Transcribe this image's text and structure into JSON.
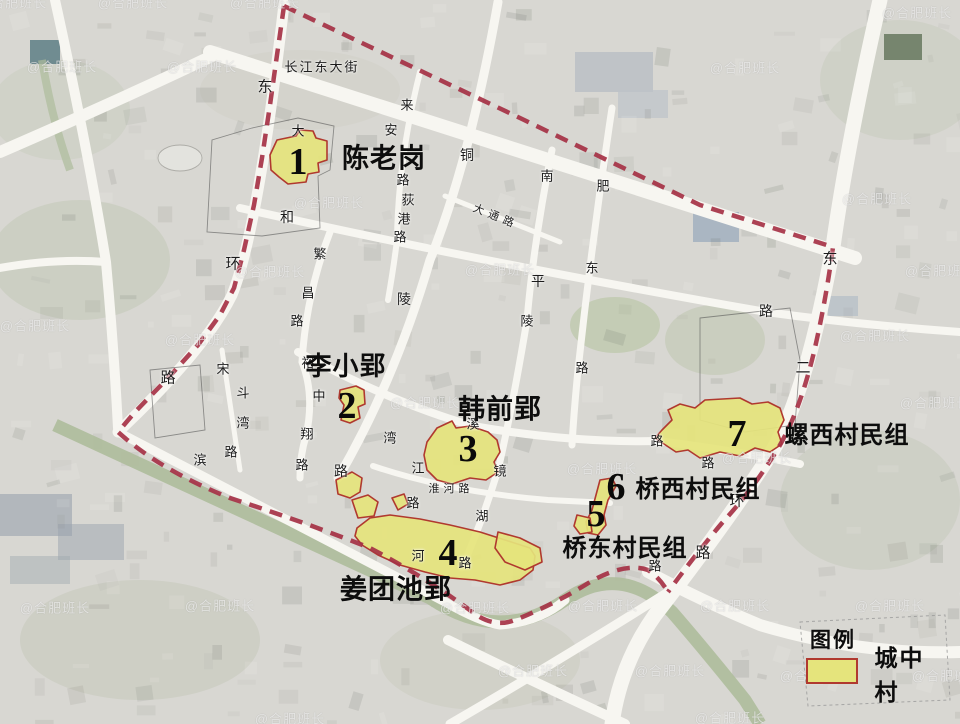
{
  "sites": [
    {
      "num": "1",
      "name": "陈老岗",
      "num_x": 298,
      "num_y": 162,
      "label_x": 384,
      "label_y": 159,
      "label_size": 27
    },
    {
      "num": "2",
      "name": "李小郢",
      "num_x": 347,
      "num_y": 406,
      "label_x": 346,
      "label_y": 366,
      "label_size": 26
    },
    {
      "num": "3",
      "name": "韩前郢",
      "num_x": 468,
      "num_y": 449,
      "label_x": 500,
      "label_y": 410,
      "label_size": 27
    },
    {
      "num": "4",
      "name": "姜团池郢",
      "num_x": 448,
      "num_y": 553,
      "label_x": 396,
      "label_y": 590,
      "label_size": 27
    },
    {
      "num": "5",
      "name": "桥东村民组",
      "num_x": 596,
      "num_y": 514,
      "label_x": 625,
      "label_y": 549,
      "label_size": 24
    },
    {
      "num": "6",
      "name": "桥西村民组",
      "num_x": 616,
      "num_y": 487,
      "label_x": 698,
      "label_y": 490,
      "label_size": 24
    },
    {
      "num": "7",
      "name": "螺西村民组",
      "num_x": 737,
      "num_y": 434,
      "label_x": 847,
      "label_y": 436,
      "label_size": 24
    }
  ],
  "legend": {
    "title": "图例",
    "item_label": "城中村"
  },
  "road_labels": [
    {
      "t": "长江东大街",
      "x": 322,
      "y": 66,
      "s": 13,
      "ls": 2
    },
    {
      "t": "东",
      "x": 265,
      "y": 86,
      "s": 15
    },
    {
      "t": "环",
      "x": 233,
      "y": 263,
      "s": 15
    },
    {
      "t": "路",
      "x": 168,
      "y": 377,
      "s": 15
    },
    {
      "t": "大",
      "x": 298,
      "y": 130,
      "s": 13
    },
    {
      "t": "来",
      "x": 407,
      "y": 104,
      "s": 13
    },
    {
      "t": "安",
      "x": 391,
      "y": 129,
      "s": 13
    },
    {
      "t": "路",
      "x": 403,
      "y": 179,
      "s": 13
    },
    {
      "t": "荻",
      "x": 408,
      "y": 199,
      "s": 13
    },
    {
      "t": "港",
      "x": 404,
      "y": 218,
      "s": 13
    },
    {
      "t": "路",
      "x": 400,
      "y": 236,
      "s": 13
    },
    {
      "t": "铜",
      "x": 467,
      "y": 155,
      "s": 14
    },
    {
      "t": "陵",
      "x": 404,
      "y": 299,
      "s": 14
    },
    {
      "t": "路",
      "x": 341,
      "y": 471,
      "s": 14
    },
    {
      "t": "大通路",
      "x": 496,
      "y": 216,
      "s": 11,
      "ls": 5,
      "rot": 22
    },
    {
      "t": "和",
      "x": 287,
      "y": 217,
      "s": 14
    },
    {
      "t": "平",
      "x": 538,
      "y": 281,
      "s": 14
    },
    {
      "t": "路",
      "x": 766,
      "y": 311,
      "s": 14
    },
    {
      "t": "南",
      "x": 547,
      "y": 175,
      "s": 13
    },
    {
      "t": "陵",
      "x": 527,
      "y": 320,
      "s": 13
    },
    {
      "t": "镜",
      "x": 500,
      "y": 470,
      "s": 13
    },
    {
      "t": "湖",
      "x": 482,
      "y": 515,
      "s": 13
    },
    {
      "t": "路",
      "x": 465,
      "y": 562,
      "s": 13
    },
    {
      "t": "肥",
      "x": 603,
      "y": 185,
      "s": 13
    },
    {
      "t": "东",
      "x": 592,
      "y": 267,
      "s": 13
    },
    {
      "t": "路",
      "x": 582,
      "y": 367,
      "s": 13
    },
    {
      "t": "繁",
      "x": 320,
      "y": 253,
      "s": 13
    },
    {
      "t": "昌",
      "x": 308,
      "y": 292,
      "s": 13
    },
    {
      "t": "路",
      "x": 297,
      "y": 320,
      "s": 13
    },
    {
      "t": "裕",
      "x": 308,
      "y": 362,
      "s": 13
    },
    {
      "t": "溪",
      "x": 473,
      "y": 423,
      "s": 13
    },
    {
      "t": "路",
      "x": 657,
      "y": 440,
      "s": 13
    },
    {
      "t": "中",
      "x": 319,
      "y": 395,
      "s": 13
    },
    {
      "t": "翔",
      "x": 307,
      "y": 433,
      "s": 13
    },
    {
      "t": "路",
      "x": 302,
      "y": 464,
      "s": 13
    },
    {
      "t": "宋",
      "x": 223,
      "y": 368,
      "s": 13
    },
    {
      "t": "斗",
      "x": 243,
      "y": 392,
      "s": 13
    },
    {
      "t": "湾",
      "x": 243,
      "y": 422,
      "s": 13
    },
    {
      "t": "路",
      "x": 231,
      "y": 451,
      "s": 13
    },
    {
      "t": "滨",
      "x": 200,
      "y": 459,
      "s": 13
    },
    {
      "t": "湾",
      "x": 390,
      "y": 437,
      "s": 13
    },
    {
      "t": "江",
      "x": 418,
      "y": 467,
      "s": 13
    },
    {
      "t": "淮河路",
      "x": 451,
      "y": 488,
      "s": 11,
      "ls": 4
    },
    {
      "t": "河",
      "x": 418,
      "y": 555,
      "s": 13
    },
    {
      "t": "路",
      "x": 413,
      "y": 502,
      "s": 13
    },
    {
      "t": "东",
      "x": 830,
      "y": 258,
      "s": 15
    },
    {
      "t": "二",
      "x": 803,
      "y": 367,
      "s": 15
    },
    {
      "t": "环",
      "x": 737,
      "y": 500,
      "s": 15
    },
    {
      "t": "路",
      "x": 703,
      "y": 552,
      "s": 15
    },
    {
      "t": "路",
      "x": 708,
      "y": 462,
      "s": 13
    },
    {
      "t": "路",
      "x": 655,
      "y": 565,
      "s": 13
    }
  ],
  "watermark": {
    "text": "@合肥班长",
    "positions": [
      [
        12,
        2
      ],
      [
        133,
        2
      ],
      [
        265,
        2
      ],
      [
        62,
        66
      ],
      [
        202,
        66
      ],
      [
        745,
        67
      ],
      [
        917,
        12
      ],
      [
        329,
        202
      ],
      [
        877,
        198
      ],
      [
        500,
        269
      ],
      [
        940,
        270
      ],
      [
        270,
        271
      ],
      [
        35,
        325
      ],
      [
        875,
        335
      ],
      [
        200,
        339
      ],
      [
        935,
        402
      ],
      [
        425,
        402
      ],
      [
        757,
        457
      ],
      [
        602,
        468
      ],
      [
        55,
        607
      ],
      [
        220,
        605
      ],
      [
        475,
        607
      ],
      [
        603,
        605
      ],
      [
        735,
        605
      ],
      [
        890,
        605
      ],
      [
        533,
        670
      ],
      [
        670,
        670
      ],
      [
        815,
        675
      ],
      [
        947,
        675
      ],
      [
        290,
        718
      ],
      [
        730,
        717
      ]
    ]
  },
  "colors": {
    "boundary": "#A63246",
    "site_fill": "#E5E47C",
    "site_stroke": "#B0392F",
    "road": "#F7F6F1",
    "river": "#AEBC9B",
    "base": "#D8D7D2"
  }
}
